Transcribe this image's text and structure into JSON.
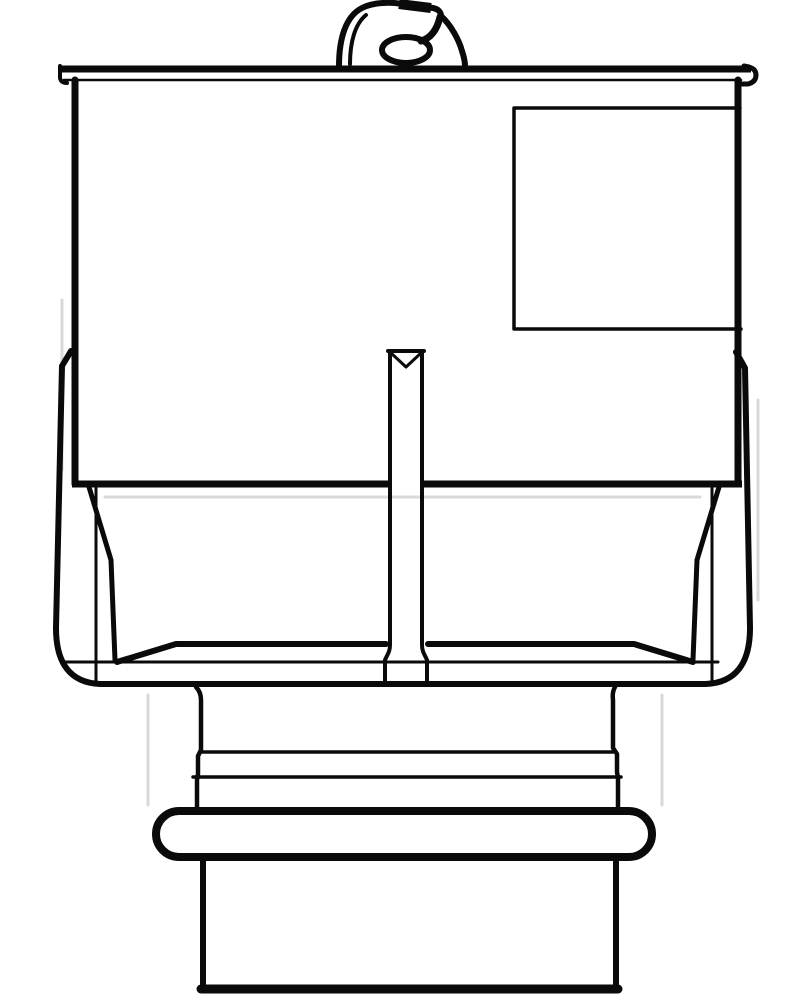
{
  "page": {
    "kind": "technical-line-drawing",
    "description": "Monochrome outline drawing (front elevation) of a molded housing: top retaining clip, flanged lid, rectangular body with side label panel, central rib, lower skirt, stepped neck, O-ring seal and bottom spigot",
    "background_color": "#ffffff"
  },
  "drawing": {
    "canvas": {
      "width": 801,
      "height": 1000
    },
    "ink_color": "#0a0a0a",
    "artifact_color": "#d9d9d9",
    "parts": [
      {
        "id": "retaining-clip",
        "label": "Retaining clip / pull tab"
      },
      {
        "id": "lid-flange",
        "label": "Lid flange with rolled ends"
      },
      {
        "id": "housing-body",
        "label": "Main housing body"
      },
      {
        "id": "label-panel",
        "label": "Recessed side panel"
      },
      {
        "id": "center-rib",
        "label": "Central rib with V notch"
      },
      {
        "id": "lower-skirt",
        "label": "Lower skirt / outer shell"
      },
      {
        "id": "skirt-floor",
        "label": "Inner floor pan"
      },
      {
        "id": "neck",
        "label": "Stepped neck with groove lines"
      },
      {
        "id": "o-ring",
        "label": "O-ring seal"
      },
      {
        "id": "bottom-spigot",
        "label": "Bottom spigot / plug barrel"
      }
    ]
  }
}
